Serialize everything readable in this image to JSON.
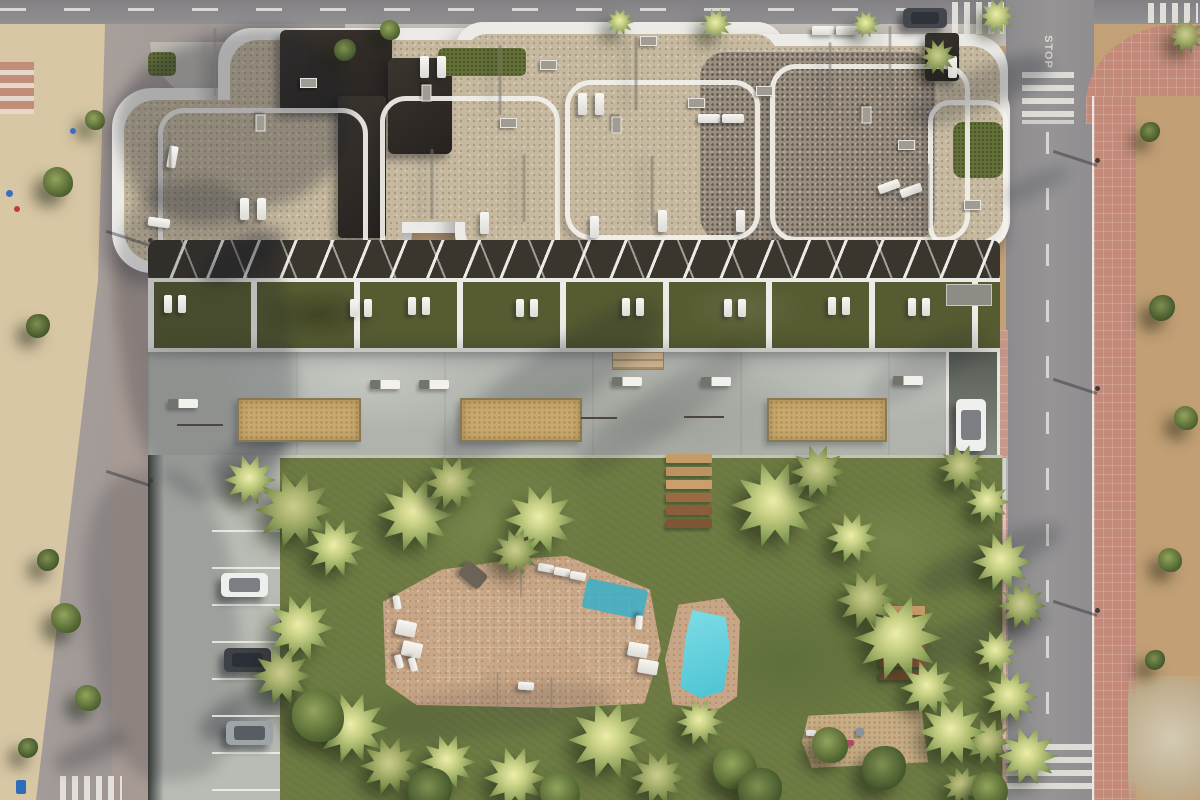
{
  "meta": {
    "description": "Aerial 3D render of a modern apartment complex with rooftop terraces, communal free-form pool, gardens, petanque courts, playground, parking and surrounding streets",
    "road_marking": "STOP"
  },
  "colors": {
    "grass": "#6e7c44",
    "pool_water": "#5fd0dd",
    "pool_deck": "#c7a687",
    "roof_gravel": "#c6b99f",
    "dark_roof": "#332e29",
    "building_white": "#edebe7",
    "promenade": "#b0b3ac",
    "road": "#919092",
    "red_sidewalk": "#c38a7a",
    "sand": "#d7c7a4",
    "dirt": "#c29f74",
    "court_sand": "#c9a96d"
  },
  "scene": {
    "building_shapes": [
      {
        "cls": "lobe",
        "x": 112,
        "y": 88,
        "w": 300,
        "h": 185,
        "r": 40
      },
      {
        "cls": "lobe",
        "x": 218,
        "y": 28,
        "w": 340,
        "h": 205,
        "r": 34
      },
      {
        "cls": "lobe",
        "x": 455,
        "y": 22,
        "w": 330,
        "h": 240,
        "r": 28
      },
      {
        "cls": "lobe",
        "x": 688,
        "y": 34,
        "w": 320,
        "h": 220,
        "r": 36
      },
      {
        "cls": "lobe",
        "x": 905,
        "y": 80,
        "w": 105,
        "h": 170,
        "r": 30
      },
      {
        "cls": "rooftan",
        "x": 124,
        "y": 100,
        "w": 278,
        "h": 162,
        "r": 32
      },
      {
        "cls": "rooftan",
        "x": 230,
        "y": 40,
        "w": 318,
        "h": 182,
        "r": 28
      },
      {
        "cls": "rooftan",
        "x": 465,
        "y": 34,
        "w": 312,
        "h": 218,
        "r": 22
      },
      {
        "cls": "rooftan",
        "x": 698,
        "y": 46,
        "w": 302,
        "h": 198,
        "r": 30
      },
      {
        "cls": "rooftan",
        "x": 915,
        "y": 92,
        "w": 88,
        "h": 148,
        "r": 24
      },
      {
        "cls": "roofdark",
        "x": 700,
        "y": 52,
        "w": 235,
        "h": 190,
        "r": 26
      },
      {
        "cls": "roofblock",
        "x": 280,
        "y": 30,
        "w": 112,
        "h": 82,
        "r": 6
      },
      {
        "cls": "roofblock",
        "x": 388,
        "y": 58,
        "w": 64,
        "h": 96,
        "r": 6
      },
      {
        "cls": "roofblock",
        "x": 338,
        "y": 96,
        "w": 48,
        "h": 142,
        "r": 4
      },
      {
        "cls": "roofblock",
        "x": 925,
        "y": 33,
        "w": 34,
        "h": 48,
        "r": 4
      },
      {
        "cls": "roofgreen",
        "x": 438,
        "y": 48,
        "w": 88,
        "h": 28,
        "r": 6
      },
      {
        "cls": "roofgreen",
        "x": 953,
        "y": 122,
        "w": 50,
        "h": 56,
        "r": 10
      },
      {
        "cls": "roofgreen",
        "x": 148,
        "y": 52,
        "w": 28,
        "h": 24,
        "r": 6
      },
      {
        "cls": "frame",
        "x": 158,
        "y": 108,
        "w": 200,
        "h": 150,
        "r": 26
      },
      {
        "cls": "frame",
        "x": 380,
        "y": 96,
        "w": 170,
        "h": 168,
        "r": 26
      },
      {
        "cls": "frame",
        "x": 565,
        "y": 80,
        "w": 185,
        "h": 150,
        "r": 26
      },
      {
        "cls": "frame",
        "x": 770,
        "y": 64,
        "w": 190,
        "h": 168,
        "r": 26
      },
      {
        "cls": "frame",
        "x": 928,
        "y": 100,
        "w": 70,
        "h": 138,
        "r": 22
      }
    ],
    "shades": [
      [
        118,
        35,
        230,
        180,
        -18,
        0.3
      ],
      [
        120,
        180,
        170,
        320,
        -8,
        0.22
      ],
      [
        88,
        470,
        150,
        310,
        -6,
        0.17
      ],
      [
        196,
        240,
        95,
        34,
        -30,
        0.3
      ],
      [
        208,
        440,
        85,
        30,
        -30,
        0.26
      ],
      [
        196,
        690,
        110,
        38,
        -28,
        0.3
      ],
      [
        52,
        738,
        76,
        26,
        -24,
        0.22
      ],
      [
        420,
        352,
        260,
        64,
        -35,
        0.18
      ],
      [
        560,
        390,
        200,
        44,
        -35,
        0.14
      ],
      [
        860,
        346,
        130,
        40,
        -30,
        0.13
      ],
      [
        905,
        70,
        150,
        40,
        -22,
        0.25
      ],
      [
        915,
        540,
        150,
        36,
        -22,
        0.2
      ],
      [
        890,
        620,
        160,
        40,
        -20,
        0.18
      ],
      [
        1000,
        175,
        70,
        20,
        -25,
        0.18
      ],
      [
        380,
        688,
        230,
        48,
        -6,
        0.13
      ],
      [
        148,
        344,
        858,
        14,
        0,
        0.2
      ]
    ],
    "parasols": [
      [
        215,
        62,
        50
      ],
      [
        170,
        168,
        52
      ],
      [
        500,
        80,
        52
      ],
      [
        636,
        74,
        54
      ],
      [
        432,
        184,
        52
      ],
      [
        524,
        188,
        50
      ],
      [
        652,
        191,
        52
      ],
      [
        830,
        76,
        50
      ],
      [
        890,
        57,
        46
      ],
      [
        928,
        196,
        48
      ],
      [
        521,
        577,
        30
      ],
      [
        497,
        689,
        27
      ],
      [
        551,
        695,
        27
      ]
    ],
    "pads": [
      [
        240,
        198,
        9,
        22,
        0
      ],
      [
        257,
        198,
        9,
        22,
        0
      ],
      [
        148,
        218,
        22,
        9,
        8
      ],
      [
        168,
        146,
        9,
        22,
        10
      ],
      [
        420,
        56,
        9,
        22,
        0
      ],
      [
        437,
        56,
        9,
        22,
        0
      ],
      [
        578,
        93,
        9,
        22,
        0
      ],
      [
        595,
        93,
        9,
        22,
        0
      ],
      [
        698,
        114,
        22,
        9,
        0
      ],
      [
        722,
        114,
        22,
        9,
        0
      ],
      [
        812,
        26,
        22,
        9,
        0
      ],
      [
        836,
        26,
        22,
        9,
        0
      ],
      [
        878,
        182,
        22,
        9,
        -20
      ],
      [
        900,
        186,
        22,
        9,
        -20
      ],
      [
        948,
        56,
        9,
        22,
        0
      ],
      [
        480,
        212,
        9,
        22,
        0
      ],
      [
        590,
        216,
        9,
        22,
        0
      ],
      [
        658,
        210,
        9,
        22,
        0
      ],
      [
        736,
        210,
        9,
        22,
        0
      ],
      [
        164,
        295,
        8,
        18,
        0
      ],
      [
        178,
        295,
        8,
        18,
        0
      ],
      [
        350,
        299,
        8,
        18,
        0
      ],
      [
        364,
        299,
        8,
        18,
        0
      ],
      [
        408,
        297,
        8,
        18,
        0
      ],
      [
        422,
        297,
        8,
        18,
        0
      ],
      [
        516,
        299,
        8,
        18,
        0
      ],
      [
        530,
        299,
        8,
        18,
        0
      ],
      [
        622,
        298,
        8,
        18,
        0
      ],
      [
        636,
        298,
        8,
        18,
        0
      ],
      [
        724,
        299,
        8,
        18,
        0
      ],
      [
        738,
        299,
        8,
        18,
        0
      ],
      [
        828,
        297,
        8,
        18,
        0
      ],
      [
        842,
        297,
        8,
        18,
        0
      ],
      [
        908,
        298,
        8,
        18,
        0
      ],
      [
        922,
        298,
        8,
        18,
        0
      ],
      [
        390,
        599,
        14,
        7,
        80
      ],
      [
        396,
        621,
        20,
        15,
        12
      ],
      [
        402,
        642,
        20,
        15,
        12
      ],
      [
        392,
        658,
        14,
        7,
        75
      ],
      [
        406,
        661,
        14,
        7,
        75
      ],
      [
        538,
        564,
        16,
        8,
        10
      ],
      [
        554,
        568,
        16,
        8,
        10
      ],
      [
        570,
        572,
        16,
        8,
        10
      ],
      [
        632,
        619,
        14,
        7,
        95
      ],
      [
        628,
        643,
        20,
        14,
        10
      ],
      [
        638,
        660,
        20,
        14,
        10
      ],
      [
        518,
        682,
        16,
        8,
        4
      ]
    ],
    "towels": [
      [
        460,
        566,
        26,
        18,
        40
      ]
    ],
    "vents": [
      [
        300,
        78,
        0
      ],
      [
        418,
        88,
        90
      ],
      [
        500,
        118,
        0
      ],
      [
        608,
        120,
        90
      ],
      [
        688,
        98,
        0
      ],
      [
        756,
        86,
        0
      ],
      [
        858,
        110,
        90
      ],
      [
        898,
        140,
        0
      ],
      [
        252,
        118,
        90
      ],
      [
        540,
        60,
        0
      ],
      [
        640,
        36,
        0
      ],
      [
        964,
        200,
        0
      ]
    ],
    "courts": [
      [
        237,
        398,
        120,
        40
      ],
      [
        460,
        398,
        118,
        40
      ],
      [
        767,
        398,
        116,
        40
      ]
    ],
    "sticks": [
      [
        177,
        424,
        46
      ],
      [
        581,
        417,
        36
      ],
      [
        684,
        416,
        40
      ]
    ],
    "benches": [
      [
        168,
        399
      ],
      [
        370,
        380
      ],
      [
        419,
        380
      ],
      [
        612,
        377
      ],
      [
        701,
        377
      ],
      [
        893,
        376
      ]
    ],
    "plank_sets": [
      {
        "x": 666,
        "y": 454,
        "w": 46,
        "gap": 13,
        "n": 6
      },
      {
        "x": 879,
        "y": 606,
        "w": 46,
        "gap": 13,
        "n": 6
      }
    ],
    "plank_colors": [
      "#c59c68",
      "#bd9260",
      "#c9a06b",
      "#9a6a42",
      "#8a5d3b",
      "#7e5535"
    ],
    "parking_lines_y": [
      530,
      567,
      604,
      641,
      678,
      715,
      752,
      789
    ],
    "cars": [
      {
        "x": 903,
        "y": 8,
        "w": 44,
        "h": 20,
        "c": "#43464b"
      },
      {
        "x": 956,
        "y": 399,
        "w": 30,
        "h": 52,
        "c": "#eff0ee"
      },
      {
        "x": 221,
        "y": 573,
        "w": 47,
        "h": 24,
        "c": "#edefed"
      },
      {
        "x": 224,
        "y": 648,
        "w": 47,
        "h": 24,
        "c": "#3e4145"
      },
      {
        "x": 226,
        "y": 721,
        "w": 47,
        "h": 24,
        "c": "#9fa4a6"
      }
    ],
    "playthings": [
      [
        818,
        733,
        10,
        8,
        "#d5544c"
      ],
      [
        838,
        740,
        16,
        6,
        "#b44868"
      ],
      [
        856,
        728,
        8,
        8,
        "#8a949c"
      ],
      [
        806,
        730,
        10,
        6,
        "#f1efeb"
      ]
    ],
    "specks": [
      [
        6,
        190,
        7,
        "#3a6fc0"
      ],
      [
        14,
        206,
        6,
        "#c23b3b"
      ],
      [
        70,
        128,
        6,
        "#3a6fc0"
      ]
    ],
    "lamps": [
      [
        1097,
        160
      ],
      [
        1097,
        388
      ],
      [
        1097,
        610
      ],
      [
        150,
        240
      ],
      [
        150,
        480
      ]
    ],
    "trees": [
      {
        "k": "palm",
        "x": 620,
        "y": 22,
        "r": 14
      },
      {
        "k": "palm",
        "x": 716,
        "y": 24,
        "r": 16
      },
      {
        "k": "palm",
        "x": 866,
        "y": 24,
        "r": 14
      },
      {
        "k": "palm2",
        "x": 938,
        "y": 57,
        "r": 18
      },
      {
        "k": "palm",
        "x": 997,
        "y": 16,
        "r": 18
      },
      {
        "k": "palm2",
        "x": 1186,
        "y": 36,
        "r": 18
      },
      {
        "k": "bush",
        "x": 390,
        "y": 30,
        "r": 10
      },
      {
        "k": "bush2",
        "x": 345,
        "y": 50,
        "r": 11
      },
      {
        "k": "palm",
        "x": 250,
        "y": 480,
        "r": 26
      },
      {
        "k": "palm2",
        "x": 295,
        "y": 510,
        "r": 40
      },
      {
        "k": "palm",
        "x": 335,
        "y": 548,
        "r": 30
      },
      {
        "k": "palm",
        "x": 415,
        "y": 515,
        "r": 38
      },
      {
        "k": "palm2",
        "x": 452,
        "y": 483,
        "r": 28
      },
      {
        "k": "palm",
        "x": 540,
        "y": 520,
        "r": 36
      },
      {
        "k": "palm2",
        "x": 516,
        "y": 552,
        "r": 24
      },
      {
        "k": "palm",
        "x": 775,
        "y": 505,
        "r": 44
      },
      {
        "k": "palm2",
        "x": 818,
        "y": 472,
        "r": 28
      },
      {
        "k": "palm",
        "x": 852,
        "y": 538,
        "r": 26
      },
      {
        "k": "palm2",
        "x": 962,
        "y": 468,
        "r": 24
      },
      {
        "k": "palm",
        "x": 988,
        "y": 502,
        "r": 22
      },
      {
        "k": "palm",
        "x": 1002,
        "y": 562,
        "r": 30
      },
      {
        "k": "palm2",
        "x": 1022,
        "y": 606,
        "r": 24
      },
      {
        "k": "palm",
        "x": 996,
        "y": 652,
        "r": 22
      },
      {
        "k": "palm",
        "x": 1010,
        "y": 697,
        "r": 28
      },
      {
        "k": "palm2",
        "x": 988,
        "y": 742,
        "r": 24
      },
      {
        "k": "palm",
        "x": 1028,
        "y": 756,
        "r": 30
      },
      {
        "k": "palm2",
        "x": 962,
        "y": 786,
        "r": 20
      },
      {
        "k": "palm",
        "x": 352,
        "y": 728,
        "r": 36
      },
      {
        "k": "palm2",
        "x": 390,
        "y": 766,
        "r": 30
      },
      {
        "k": "palm",
        "x": 448,
        "y": 762,
        "r": 28
      },
      {
        "k": "palm",
        "x": 515,
        "y": 778,
        "r": 32
      },
      {
        "k": "palm",
        "x": 608,
        "y": 740,
        "r": 40
      },
      {
        "k": "palm2",
        "x": 658,
        "y": 778,
        "r": 28
      },
      {
        "k": "palm",
        "x": 700,
        "y": 722,
        "r": 24
      },
      {
        "k": "bush",
        "x": 735,
        "y": 768,
        "r": 22
      },
      {
        "k": "palm",
        "x": 898,
        "y": 638,
        "r": 44
      },
      {
        "k": "palm2",
        "x": 866,
        "y": 600,
        "r": 30
      },
      {
        "k": "palm",
        "x": 928,
        "y": 688,
        "r": 28
      },
      {
        "k": "palm",
        "x": 952,
        "y": 732,
        "r": 34
      },
      {
        "k": "bush2",
        "x": 884,
        "y": 768,
        "r": 22
      },
      {
        "k": "palm",
        "x": 300,
        "y": 628,
        "r": 34
      },
      {
        "k": "palm2",
        "x": 282,
        "y": 676,
        "r": 30
      },
      {
        "k": "bush",
        "x": 318,
        "y": 716,
        "r": 26
      },
      {
        "k": "bush2",
        "x": 430,
        "y": 790,
        "r": 22
      },
      {
        "k": "bush",
        "x": 560,
        "y": 792,
        "r": 20
      },
      {
        "k": "bush2",
        "x": 760,
        "y": 790,
        "r": 22
      },
      {
        "k": "bush",
        "x": 830,
        "y": 745,
        "r": 18
      },
      {
        "k": "bush",
        "x": 990,
        "y": 790,
        "r": 18
      },
      {
        "k": "bush",
        "x": 58,
        "y": 182,
        "r": 15
      },
      {
        "k": "bush2",
        "x": 38,
        "y": 326,
        "r": 12
      },
      {
        "k": "bush",
        "x": 66,
        "y": 618,
        "r": 15
      },
      {
        "k": "bush2",
        "x": 48,
        "y": 560,
        "r": 11
      },
      {
        "k": "bush",
        "x": 88,
        "y": 698,
        "r": 13
      },
      {
        "k": "bush2",
        "x": 28,
        "y": 748,
        "r": 10
      },
      {
        "k": "bush",
        "x": 95,
        "y": 120,
        "r": 10
      },
      {
        "k": "bush2",
        "x": 1162,
        "y": 308,
        "r": 13
      },
      {
        "k": "bush",
        "x": 1186,
        "y": 418,
        "r": 12
      },
      {
        "k": "bush2",
        "x": 1150,
        "y": 132,
        "r": 10
      },
      {
        "k": "bush",
        "x": 1170,
        "y": 560,
        "r": 12
      },
      {
        "k": "bush2",
        "x": 1155,
        "y": 660,
        "r": 10
      }
    ]
  }
}
